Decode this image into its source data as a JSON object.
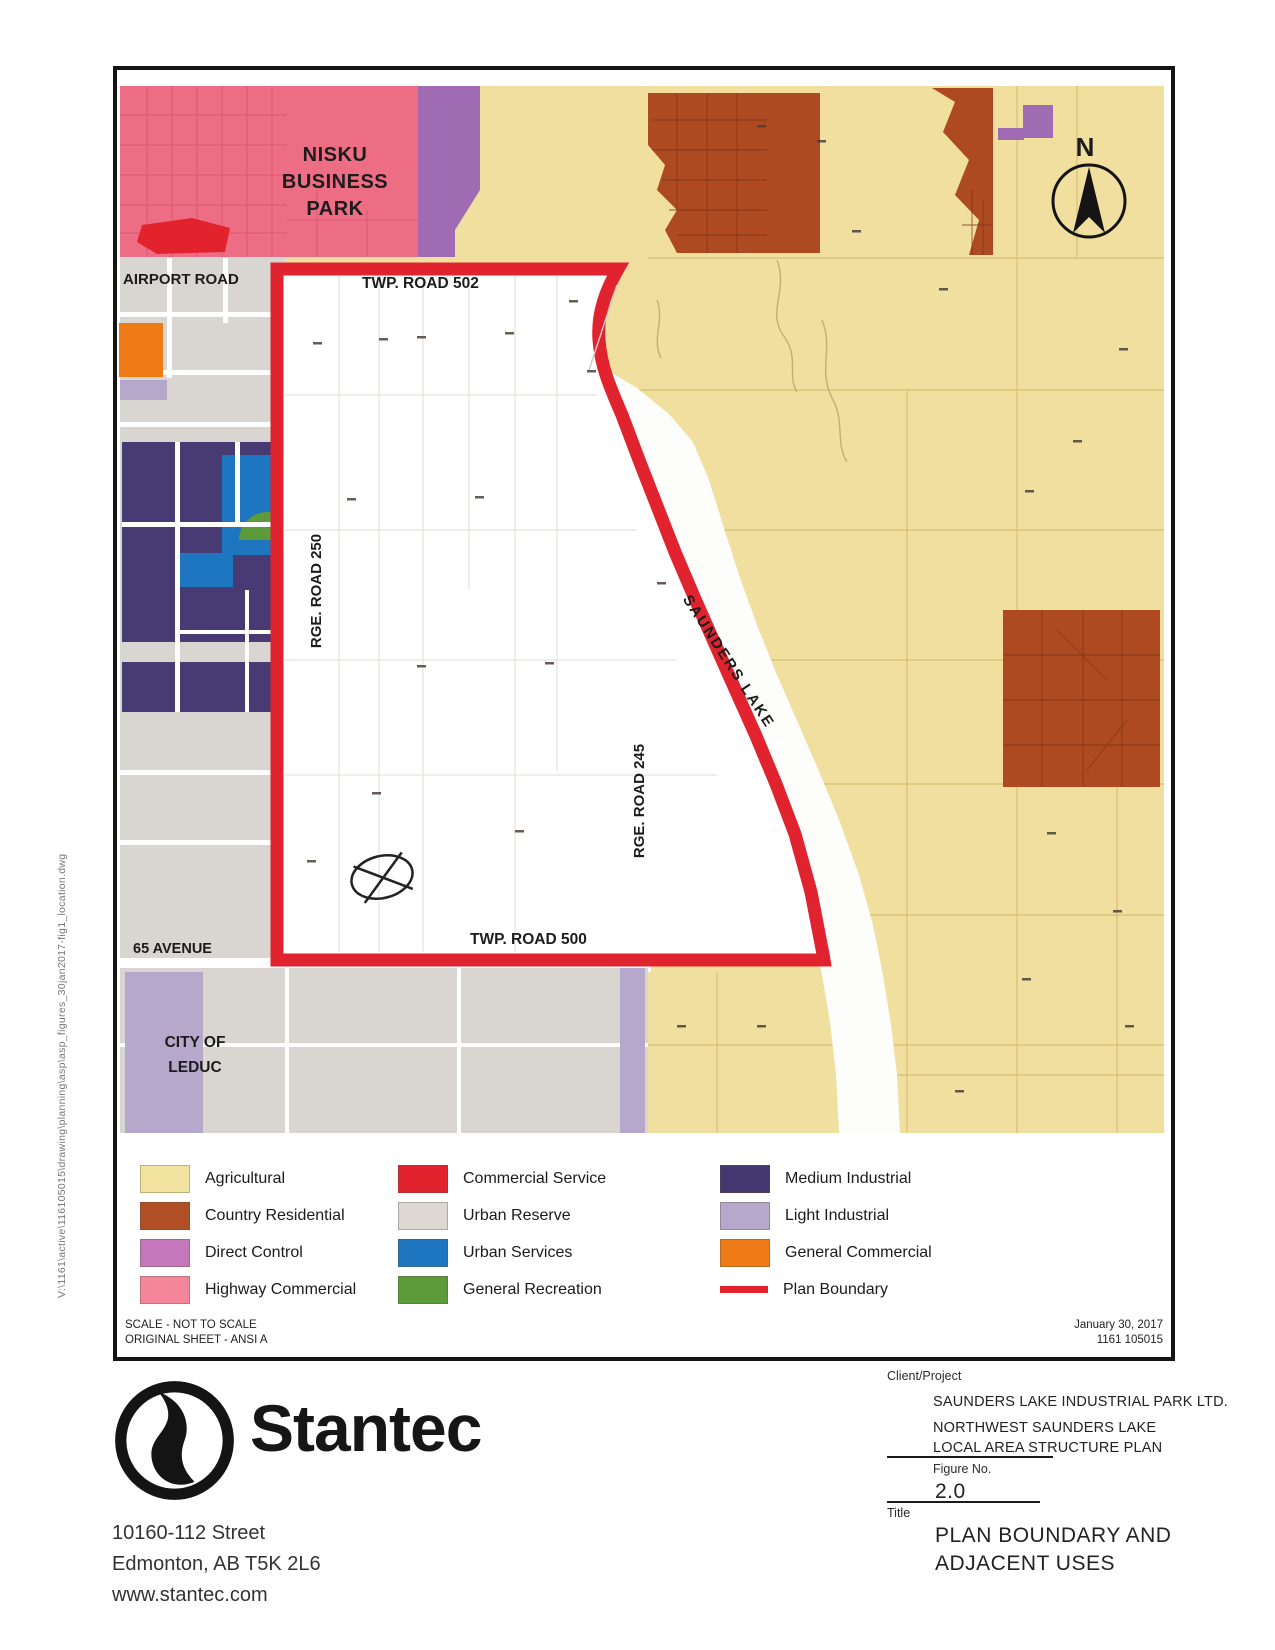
{
  "map": {
    "nisku_business_park": "NISKU\nBUSINESS\nPARK",
    "airport_road": "AIRPORT ROAD",
    "twp_road_502": "TWP. ROAD 502",
    "rge_road_250": "RGE. ROAD 250",
    "rge_road_245": "RGE. ROAD 245",
    "saunders_lake": "SAUNDERS LAKE",
    "twp_road_500": "TWP. ROAD 500",
    "avenue_65": "65 AVENUE",
    "city_of_leduc": "CITY OF\nLEDUC",
    "north_label": "N"
  },
  "legend": {
    "items": [
      {
        "label": "Agricultural",
        "color": "#f3e3a0"
      },
      {
        "label": "Country Residential",
        "color": "#b04e26"
      },
      {
        "label": "Direct Control",
        "color": "#c577bb"
      },
      {
        "label": "Highway Commercial",
        "color": "#f4859a"
      },
      {
        "label": "Commercial Service",
        "color": "#e2232e"
      },
      {
        "label": "Urban Reserve",
        "color": "#ddd8d2"
      },
      {
        "label": "Urban Services",
        "color": "#1e75c0"
      },
      {
        "label": "General Recreation",
        "color": "#5d9a3a"
      },
      {
        "label": "Medium Industrial",
        "color": "#453870"
      },
      {
        "label": "Light Industrial",
        "color": "#b5a8ca"
      },
      {
        "label": "General Commercial",
        "color": "#ef7b17"
      },
      {
        "label": "Plan Boundary",
        "color": "#e2232e"
      }
    ]
  },
  "notes": {
    "scale_line1": "SCALE - NOT TO SCALE",
    "scale_line2": "ORIGINAL SHEET - ANSI A",
    "date": "January 30, 2017",
    "project_number": "1161 105015"
  },
  "titleblock": {
    "client_project_label": "Client/Project",
    "client": "SAUNDERS LAKE INDUSTRIAL PARK LTD.",
    "project_line1": "NORTHWEST SAUNDERS LAKE",
    "project_line2": "LOCAL AREA STRUCTURE PLAN",
    "figure_label": "Figure No.",
    "figure_number": "2.0",
    "title_label": "Title",
    "title_line1": "PLAN BOUNDARY AND",
    "title_line2": "ADJACENT USES"
  },
  "footer": {
    "company": "Stantec",
    "address_line1": "10160-112 Street",
    "address_line2": "Edmonton, AB T5K 2L6",
    "address_line3": "www.stantec.com"
  },
  "file_path": "V:\\1161\\active\\116105015\\drawing\\planning\\asp\\asp_figures_30jan2017-fig1_location.dwg"
}
